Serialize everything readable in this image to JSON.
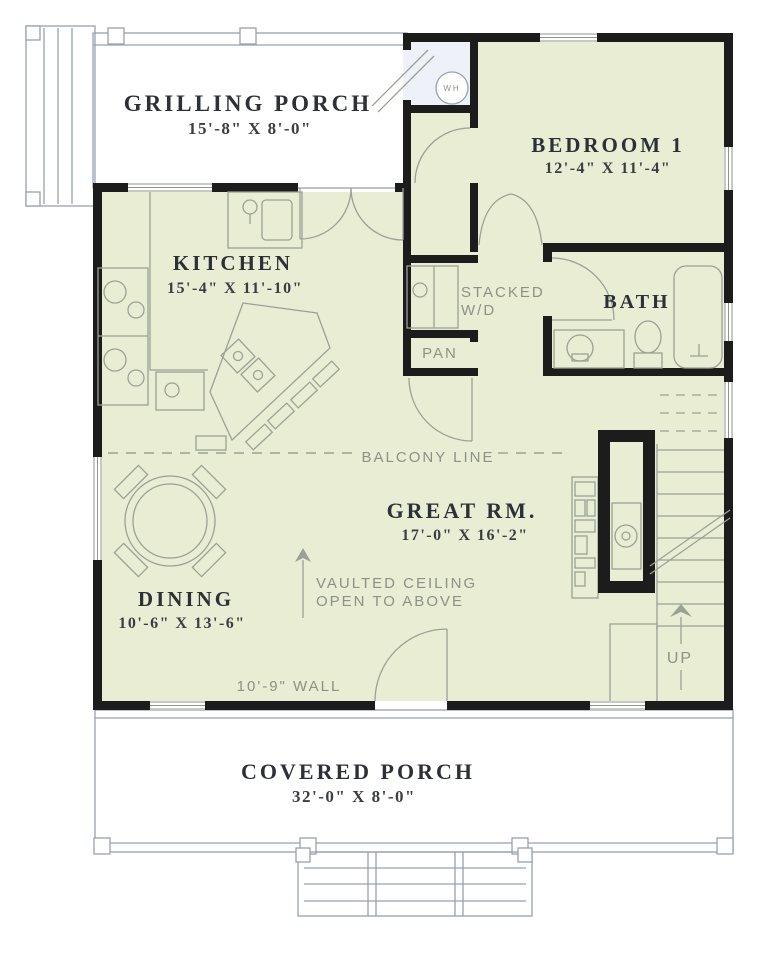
{
  "plan": {
    "rooms": {
      "grilling_porch": {
        "name": "GRILLING PORCH",
        "dims": "15'-8\" X 8'-0\""
      },
      "bedroom_1": {
        "name": "BEDROOM 1",
        "dims": "12'-4\" X 11'-4\""
      },
      "kitchen": {
        "name": "KITCHEN",
        "dims": "15'-4\" X 11'-10\""
      },
      "bath": {
        "name": "BATH"
      },
      "great_room": {
        "name": "GREAT RM.",
        "dims": "17'-0\" X 16'-2\""
      },
      "dining": {
        "name": "DINING",
        "dims": "10'-6\" X 13'-6\""
      },
      "covered_porch": {
        "name": "COVERED PORCH",
        "dims": "32'-0\" X 8'-0\""
      }
    },
    "annotations": {
      "stacked_line1": "STACKED",
      "stacked_line2": "W/D",
      "pantry": "PAN",
      "balcony": "BALCONY LINE",
      "vaulted1": "VAULTED CEILING",
      "vaulted2": "OPEN TO ABOVE",
      "wall_note": "10'-9\" WALL",
      "up": "UP",
      "water_heater": "WH"
    },
    "colors": {
      "interior": "#e8edd4",
      "porch": "#dfe5f0",
      "closet_white": "#eef1f7",
      "wall": "#1c1c1c",
      "fixture_line": "#9ba294",
      "note_text": "#8d9285",
      "room_text": "#2d3036",
      "window": "#ffffff"
    }
  }
}
